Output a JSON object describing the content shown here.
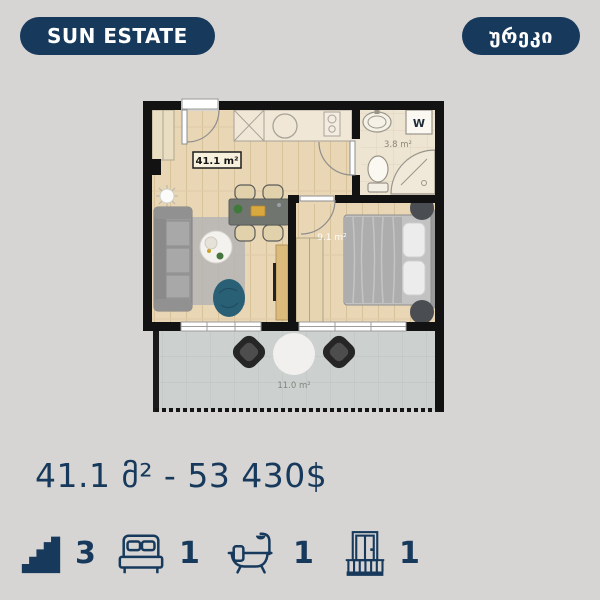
{
  "theme": {
    "background": "#d6d5d3",
    "accent": "#17395c",
    "badge_text_color": "#ffffff"
  },
  "header": {
    "brand": "SUN ESTATE",
    "location": "ურეკი"
  },
  "floorplan": {
    "living_room_label": "41.1 m²",
    "bathroom_label": "3.8 m²",
    "bedroom_label": "9.1 m²",
    "terrace_label": "11.0 m²",
    "washer_label": "W"
  },
  "summary": {
    "price_line": "41.1 მ² - 53 430$"
  },
  "stats": [
    {
      "name": "floor",
      "value": "3"
    },
    {
      "name": "bedrooms",
      "value": "1"
    },
    {
      "name": "bathrooms",
      "value": "1"
    },
    {
      "name": "balconies",
      "value": "1"
    }
  ]
}
